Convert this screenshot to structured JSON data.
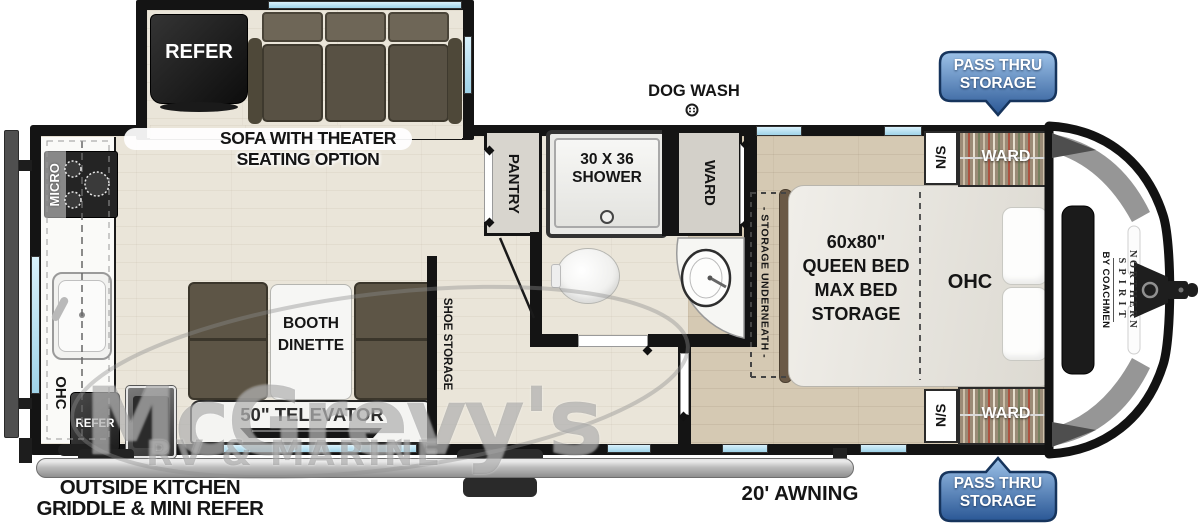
{
  "plan": {
    "slide": {
      "refer": "REFER",
      "sofa_line1": "SOFA WITH THEATER",
      "sofa_line2": "SEATING OPTION"
    },
    "kitchen": {
      "micro": "MICRO",
      "ohc": "OHC",
      "refer": "REFER"
    },
    "dinette": {
      "booth_line1": "BOOTH",
      "booth_line2": "DINETTE",
      "televator": "50\" TELEVATOR",
      "shoe_storage": "SHOE STORAGE"
    },
    "bath": {
      "dog_wash": "DOG WASH",
      "pantry": "PANTRY",
      "shower_line1": "30 X 36",
      "shower_line2": "SHOWER",
      "ward": "WARD"
    },
    "bedroom": {
      "storage_underneath": "- STORAGE UNDERNEATH -",
      "bed_line1": "60x80\"",
      "bed_line2": "QUEEN BED",
      "bed_line3": "MAX BED",
      "bed_line4": "STORAGE",
      "ohc": "OHC",
      "ns": "N/S",
      "ward": "WARD"
    },
    "exterior": {
      "outside_kitchen_line1": "OUTSIDE KITCHEN",
      "outside_kitchen_line2": "GRIDDLE & MINI REFER",
      "awning": "20' AWNING"
    },
    "badge": {
      "line1": "PASS THRU",
      "line2": "STORAGE"
    },
    "brand": {
      "line1": "NORTHERN",
      "line2": "SPIRIT",
      "line3": "BY COACHMEN"
    },
    "watermark": {
      "line1": "McGrevy's",
      "line2": "RV & MARINE"
    }
  },
  "colors": {
    "wall": "#141414",
    "window_blue": "#a9def2",
    "badge_blue_top": "#9dc2e8",
    "badge_blue_bottom": "#2a5795",
    "badge_border": "#16345c",
    "floor_main": "#eae5d9",
    "floor_bedroom": "#d5c9b3",
    "sofa_brown": "#5d5546",
    "wardrobe_brown": "#93826e",
    "appliance_dark": "#1c1c1c"
  }
}
